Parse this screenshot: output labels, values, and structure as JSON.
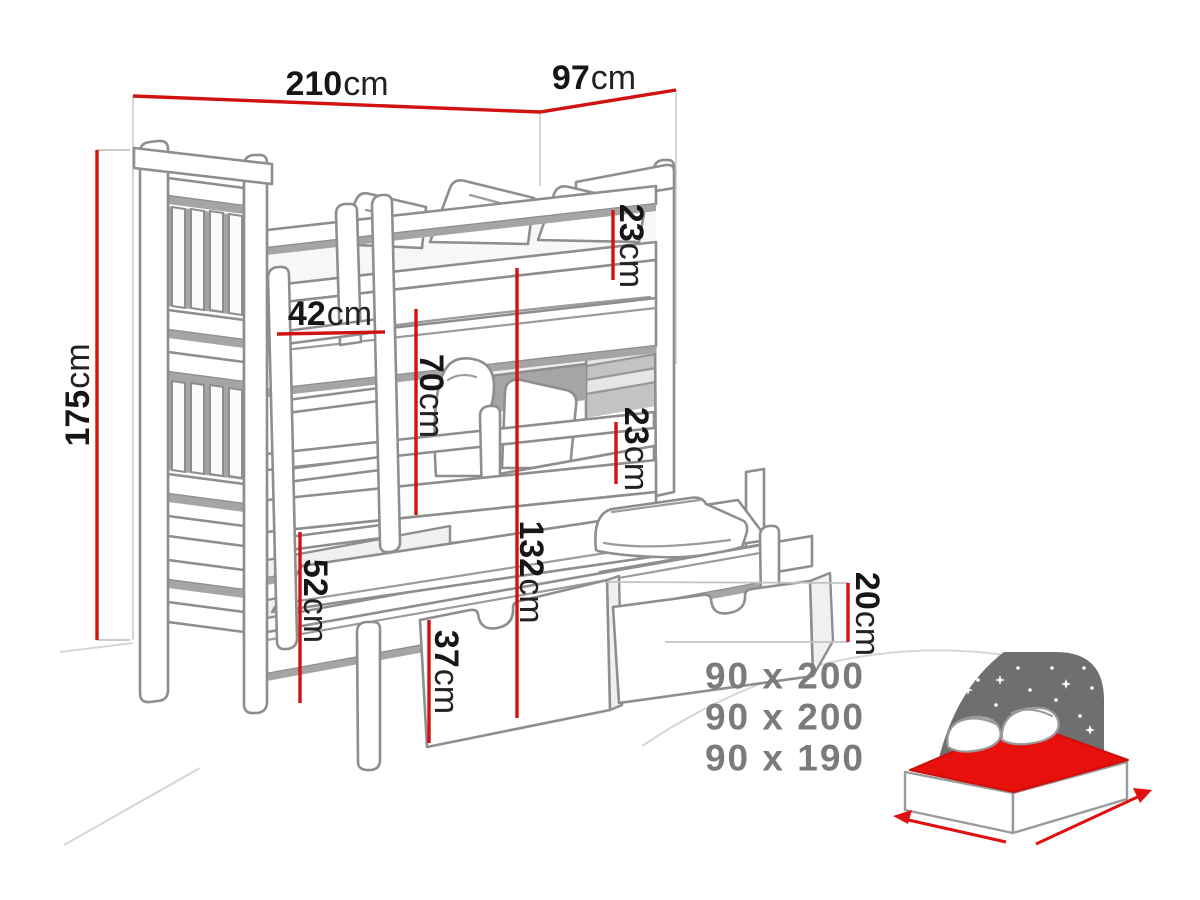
{
  "diagram": {
    "type": "bunk-bed-technical-drawing",
    "dimensions": {
      "length": {
        "value": "210",
        "unit": "cm"
      },
      "depth": {
        "value": "97",
        "unit": "cm"
      },
      "height": {
        "value": "175",
        "unit": "cm"
      },
      "top_guard_rail": {
        "value": "23",
        "unit": "cm"
      },
      "ladder_width": {
        "value": "42",
        "unit": "cm"
      },
      "bunk_clearance": {
        "value": "70",
        "unit": "cm"
      },
      "middle_guard_rail": {
        "value": "23",
        "unit": "cm"
      },
      "top_bunk_height": {
        "value": "132",
        "unit": "cm"
      },
      "trundle_height": {
        "value": "52",
        "unit": "cm"
      },
      "drawer_front_height": {
        "value": "37",
        "unit": "cm"
      },
      "drawer_side_height": {
        "value": "20",
        "unit": "cm"
      }
    },
    "mattress_sizes": [
      "90 x 200",
      "90 x 200",
      "90 x 190"
    ],
    "colors": {
      "dimension_red": "#d01310",
      "drawing_gray": "#8e8e8e",
      "label_text": "#161616",
      "sizes_text": "#7b7b7b",
      "icon_gray": "#6f6f6f",
      "icon_mattress_red": "#e8100c"
    }
  }
}
